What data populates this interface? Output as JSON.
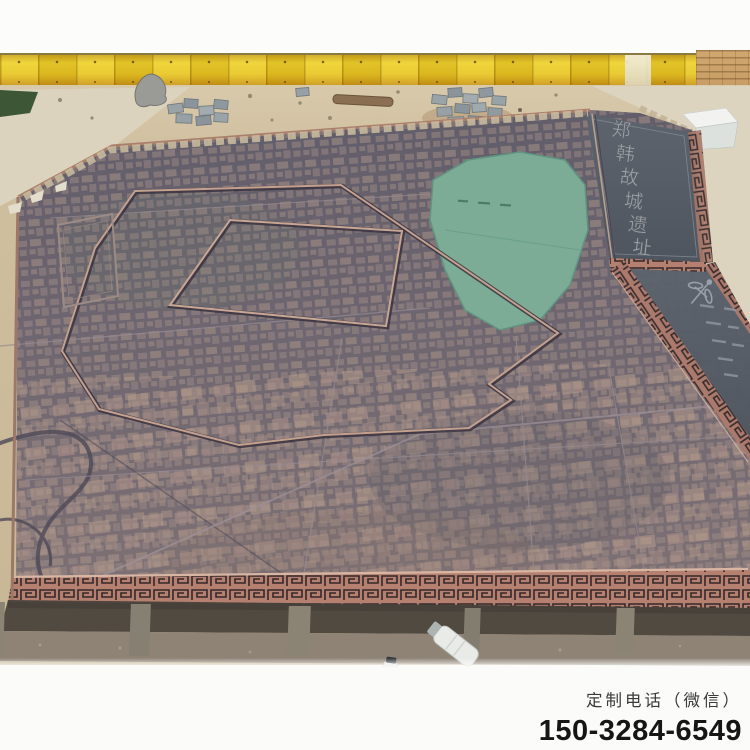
{
  "overlay_text": {
    "label": "定制电话（微信）",
    "phone": "150-3284-6549"
  },
  "map_inscription": {
    "chars": [
      "郑",
      "韩",
      "故",
      "城",
      "遗",
      "址"
    ]
  },
  "colors": {
    "fence_yellow": "#e6c423",
    "bronze_slab": "#6e6570",
    "patina_lake": "#7cab96",
    "copper_border": "#b5806f",
    "sand_ground": "#d2c1a3",
    "title_panel": "#59606a",
    "contact_text": "#161616"
  }
}
